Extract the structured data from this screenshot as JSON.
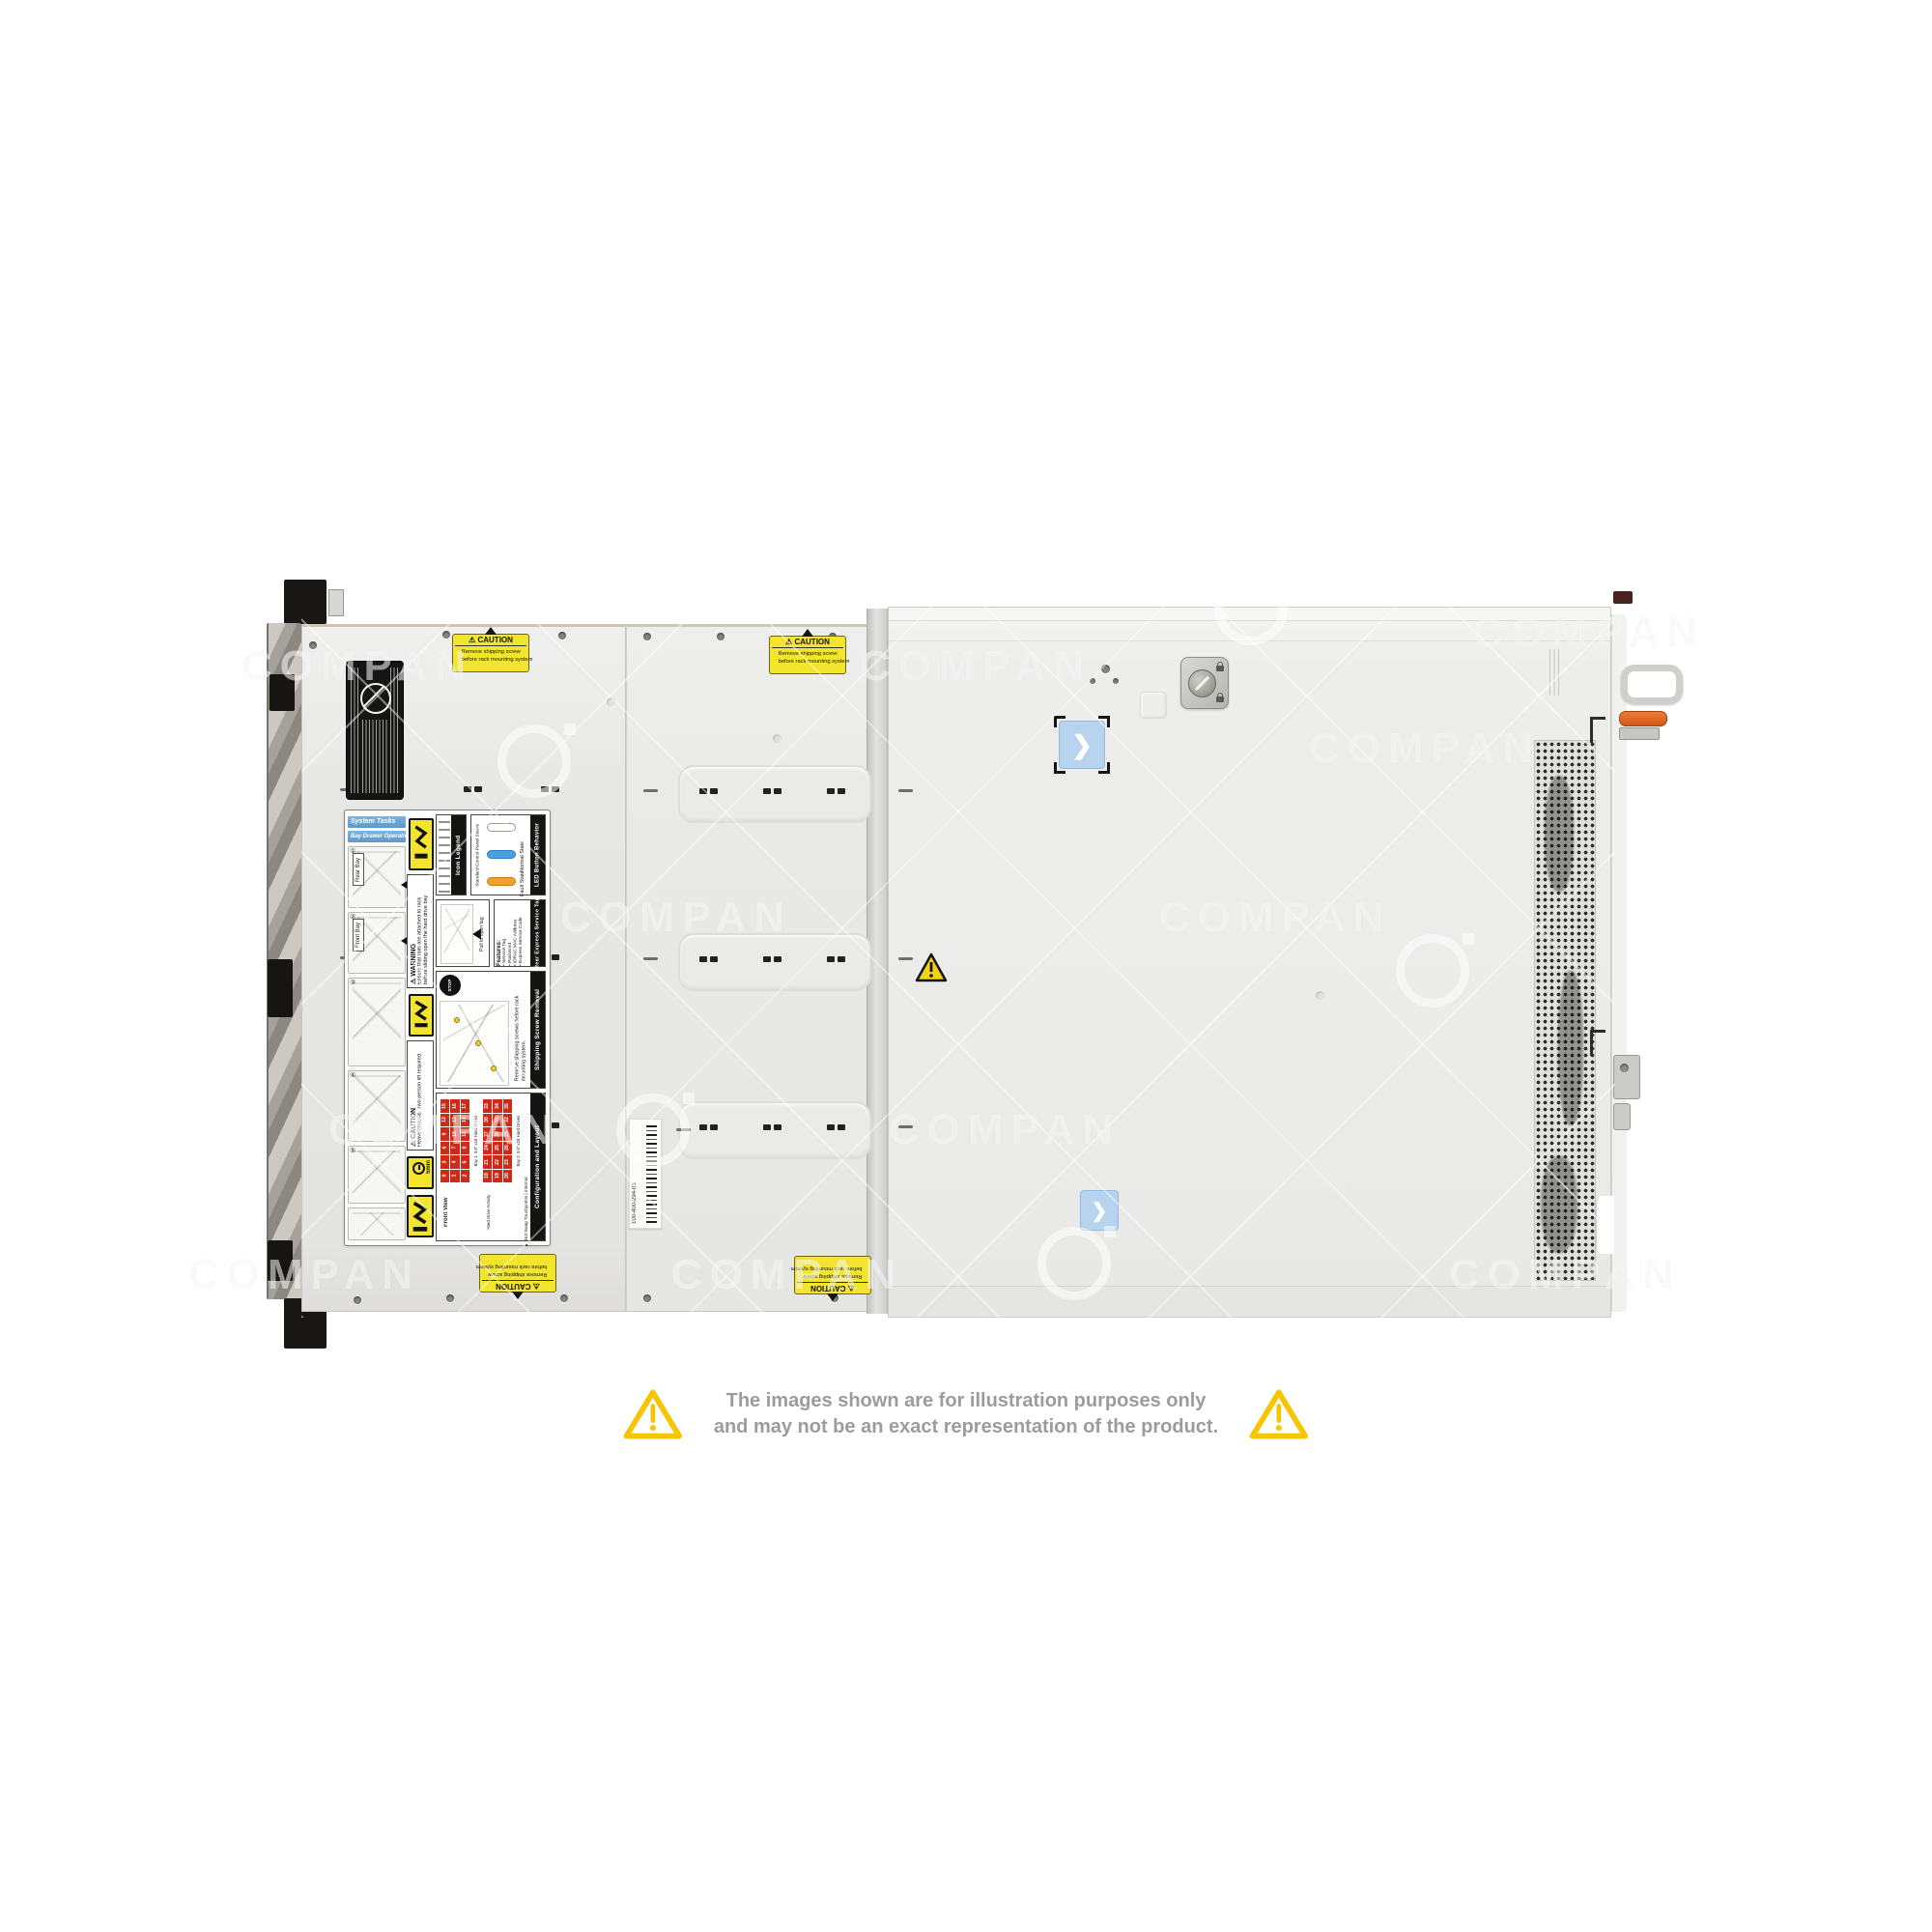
{
  "image_type": "product-photo",
  "subject": "rack-server-top-view",
  "watermark": {
    "text": "COMPAN",
    "text_positions": [
      [
        370,
        690
      ],
      [
        1010,
        690
      ],
      [
        1645,
        655
      ],
      [
        700,
        950
      ],
      [
        1320,
        950
      ],
      [
        460,
        1170
      ],
      [
        1040,
        1170
      ],
      [
        315,
        1320
      ],
      [
        815,
        1320
      ],
      [
        1620,
        1320
      ],
      [
        1475,
        775
      ]
    ],
    "logo_positions": [
      [
        1295,
        630
      ],
      [
        676,
        1170
      ],
      [
        1483,
        1005
      ],
      [
        1112,
        1308
      ],
      [
        553,
        788
      ]
    ]
  },
  "disclaimer": {
    "line1": "The images shown are for illustration purposes only",
    "line2": "and may not be an exact representation of the product.",
    "triangle_color": "#f6c400",
    "text_color": "#9c9c9c"
  },
  "labels": {
    "caution_small": {
      "title": "⚠ CAUTION",
      "line1": "Remove shipping screw",
      "line2": "before rack mounting system"
    },
    "service": {
      "system_tasks": "System Tasks",
      "bay_drawer": "Bay Drawer Operation",
      "steps": [
        "①",
        "②",
        "③",
        "④",
        "⑤"
      ],
      "rear_bay": "Rear Bay",
      "front_bay": "Front Bay",
      "warning_title": "⚠ WARNING",
      "warning_text": "Ensure that rails are attached to rack before sliding open the hard drive bay",
      "icon_legend": "Icon Legend",
      "led_title": "LED Button Behavior",
      "led_sub": "Standard Control Panel States",
      "led_normal": "Normal State",
      "led_fault": "Fault State",
      "rear_tag_title": "Rear Express Service Tag",
      "rear_tag_features": "Features:",
      "rear_tag_items": [
        "Service Tag",
        "Password",
        "iDRAC MAC Address",
        "Express Service Code"
      ],
      "pull_tag": "Pull to open tag",
      "shipping_title": "Shipping Screw Removal",
      "stop": "STOP",
      "shipping_text": "Remove shipping screws before rack mounting system.",
      "caution_heavy_title": "⚠ CAUTION",
      "caution_heavy_text": "Heavy chassis. Two person lift required.",
      "five_min": "5min",
      "config_title": "Configuration and Layout",
      "config_sub": "■ Hot Swap Touchpoints | Internal",
      "front_view": "Front View",
      "bay1": "Bay 1: 3.5\" x18 Hard Drives",
      "bay2": "Bay 2: 3.5\" x18 Hard Drives",
      "hdd_activity": "Hard Drive Activity",
      "grid1": {
        "from": 0,
        "to": 17
      },
      "grid2": {
        "from": 18,
        "to": 35
      }
    },
    "barcode_number": "100-400-294-03"
  },
  "stickers": {
    "chevron": "❯"
  },
  "colors": {
    "chassis_light": "#ededeb",
    "chassis_mid": "#e9e9e7",
    "label_yellow": "#f3e42e",
    "warning_gold": "#f6c400",
    "hdd_red": "#ce2a1a",
    "sticker_blue": "#b7d3ed",
    "handle_orange": "#e06a2b",
    "disclaimer_gray": "#9c9c9c"
  }
}
